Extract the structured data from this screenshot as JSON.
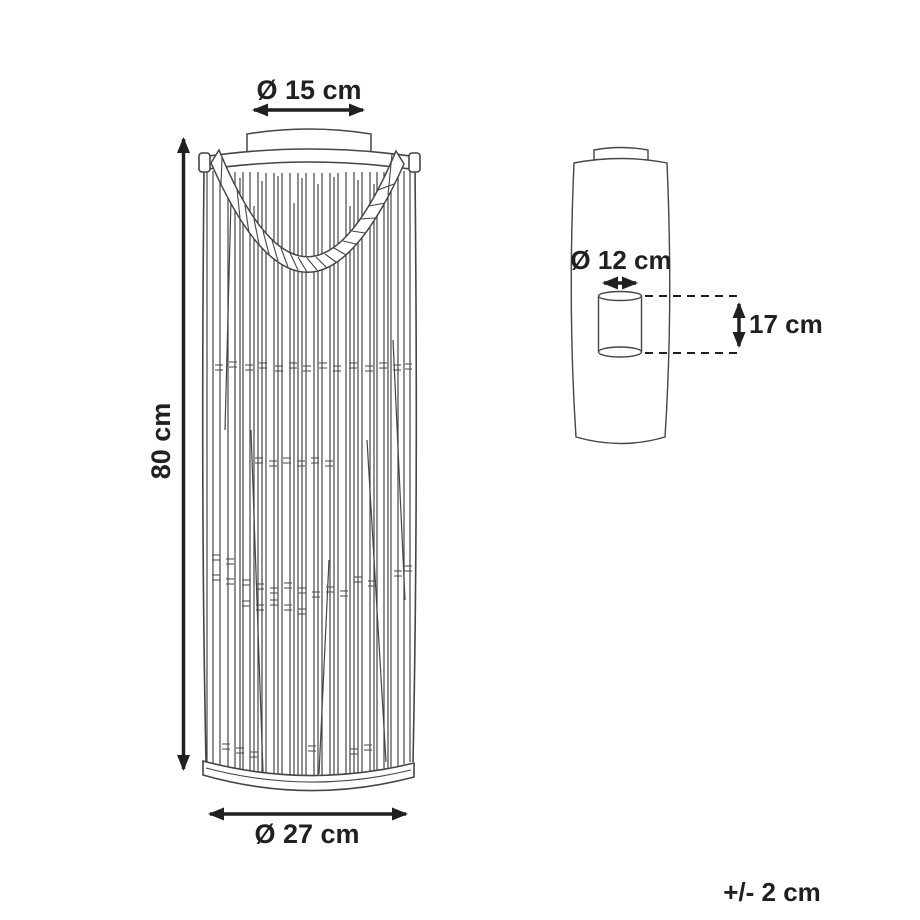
{
  "diagram": {
    "kind": "product-dimension-diagram",
    "unit": "cm",
    "colors": {
      "background": "#ffffff",
      "drawing_line": "#454545",
      "dimension_line": "#231f20",
      "text": "#231f20"
    },
    "lantern_front_view": {
      "top_diameter_label": "Ø 15 cm",
      "top_diameter_value": 15,
      "height_label": "80 cm",
      "height_value": 80,
      "base_diameter_label": "Ø 27 cm",
      "base_diameter_value": 27
    },
    "side_view_insert": {
      "inner_diameter_label": "Ø 12 cm",
      "inner_diameter_value": 12,
      "inner_height_label": "17 cm",
      "inner_height_value": 17
    },
    "tolerance": {
      "label": "+/- 2 cm",
      "value": 2
    }
  }
}
